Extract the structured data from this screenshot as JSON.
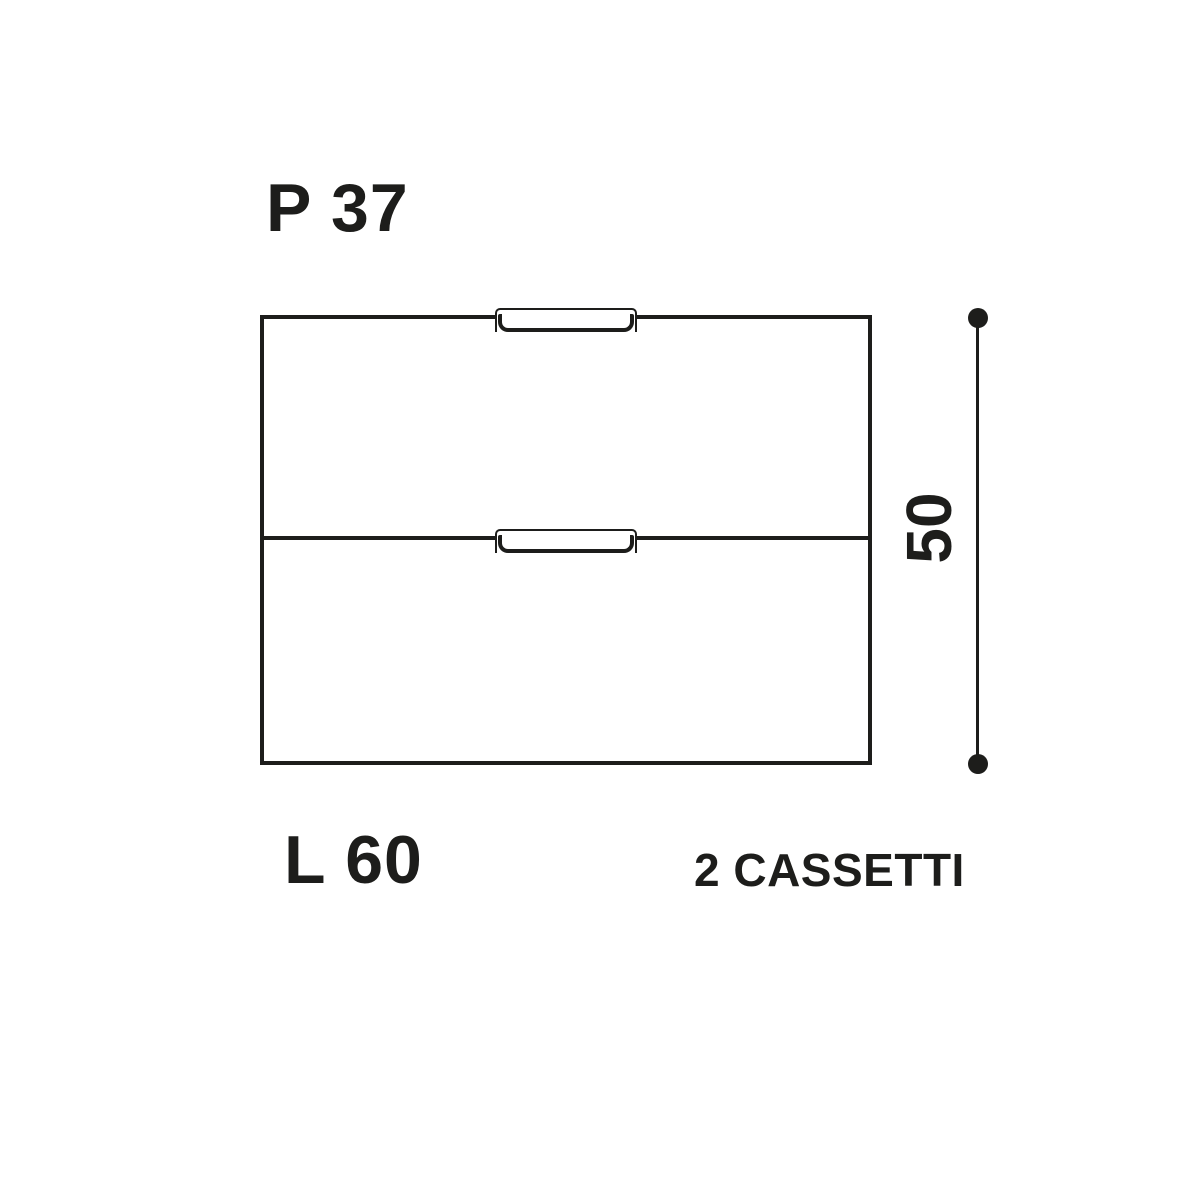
{
  "diagram": {
    "depth_label": "P 37",
    "width_label": "L 60",
    "height_label": "50",
    "drawer_count_label": "2 CASSETTI",
    "drawers": 2,
    "colors": {
      "line": "#1d1d1b",
      "background": "#ffffff"
    }
  }
}
